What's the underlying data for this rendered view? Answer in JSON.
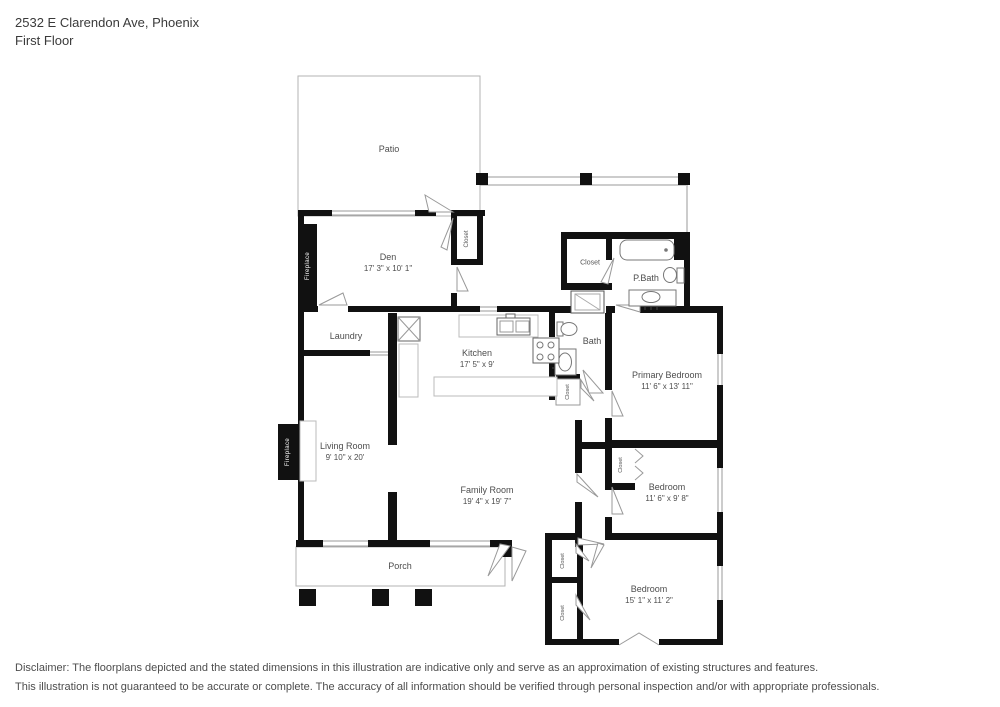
{
  "header": {
    "address": "2532 E Clarendon Ave, Phoenix",
    "floor": "First Floor"
  },
  "rooms": {
    "patio": {
      "name": "Patio"
    },
    "den": {
      "name": "Den",
      "dims": "17' 3\" x 10' 1\""
    },
    "laundry": {
      "name": "Laundry"
    },
    "kitchen": {
      "name": "Kitchen",
      "dims": "17' 5\" x 9'"
    },
    "living_room": {
      "name": "Living Room",
      "dims": "9' 10\" x 20'"
    },
    "family_room": {
      "name": "Family Room",
      "dims": "19' 4\" x 19' 7\""
    },
    "primary_bedroom": {
      "name": "Primary Bedroom",
      "dims": "11' 6\" x 13' 11\""
    },
    "bedroom_middle": {
      "name": "Bedroom",
      "dims": "11' 6\" x 9' 8\""
    },
    "bedroom_bottom": {
      "name": "Bedroom",
      "dims": "15' 1\" x 11' 2\""
    },
    "bath": {
      "name": "Bath"
    },
    "primary_bath": {
      "name": "P.Bath"
    },
    "porch": {
      "name": "Porch"
    }
  },
  "labels": {
    "closet": "Closet",
    "fireplace": "Fireplace"
  },
  "colors": {
    "wall": "#111111",
    "thin_line": "#9a9a9a",
    "label_text": "#4d4d4d"
  },
  "disclaimer": [
    "Disclaimer: The floorplans depicted and the stated dimensions in this illustration are indicative only and serve as an approximation of existing structures and features.",
    "This illustration is not guaranteed to be accurate or complete. The accuracy of all information should be verified through personal inspection and/or with appropriate professionals."
  ]
}
